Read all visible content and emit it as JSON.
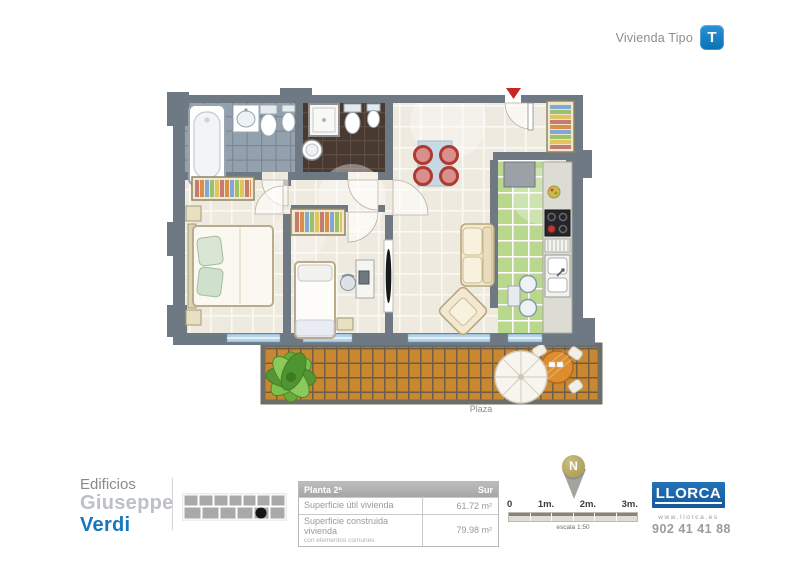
{
  "header": {
    "label": "Vivienda Tipo",
    "badge": "T"
  },
  "plan": {
    "plaza_label": "Plaza",
    "rooms": [
      "bathroom-1",
      "bathroom-2",
      "master-bedroom",
      "bedroom-2",
      "living-room",
      "dining-area",
      "kitchen",
      "entrance-hall",
      "terrace"
    ]
  },
  "footer": {
    "brand": {
      "line1": "Edificios",
      "line2": "Giuseppe",
      "line3": "Verdi"
    },
    "table": {
      "header_left": "Planta 2ª",
      "header_right": "Sur",
      "rows": [
        {
          "label": "Superficie útil vivienda",
          "sublabel": "",
          "value": "61.72 m²"
        },
        {
          "label": "Superficie construida vivienda",
          "sublabel": "con elementos comunes",
          "value": "79.98 m²"
        }
      ]
    },
    "compass": {
      "letter": "N"
    },
    "scale": {
      "ticks": [
        "0",
        "1m.",
        "2m.",
        "3m."
      ],
      "caption": "escala 1:50"
    },
    "logo": {
      "name": "LLORCA",
      "web": "www.llorca.es",
      "phone": "902 41 41 88"
    }
  },
  "colors": {
    "badge_blue": "#0e7cc0",
    "verdi_blue": "#1577bd",
    "logo_blue": "#1a63a8",
    "wall_gray": "#6e7983",
    "floor_cream": "#efeadf",
    "bath1_tile": "#93a0ad",
    "bath2_tile": "#483931",
    "kitchen_tile": "#b9d88e",
    "deck_wood": "#c9872f",
    "window_blue": "#b5d3e7",
    "chair_red": "#c0463c",
    "compass_gold": "#ac9e55"
  }
}
